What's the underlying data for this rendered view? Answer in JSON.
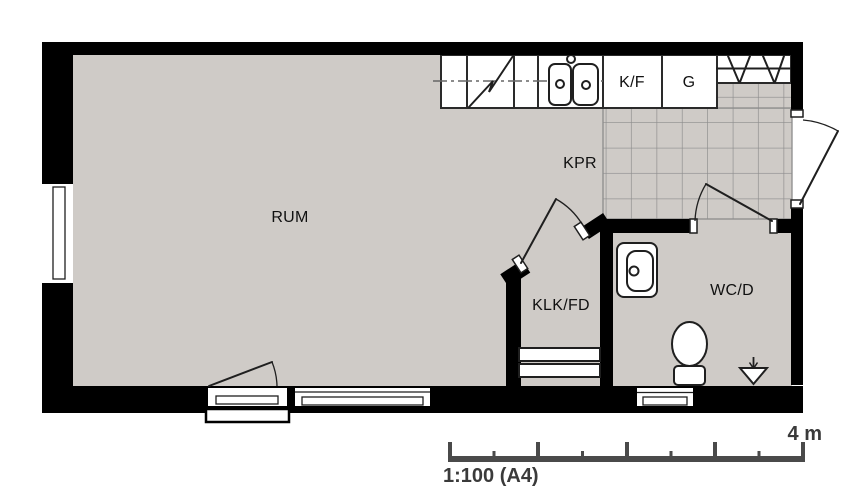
{
  "rooms": {
    "rum": {
      "label": "RUM"
    },
    "kpr": {
      "label": "KPR"
    },
    "klk_fd": {
      "label": "KLK/FD"
    },
    "wc_d": {
      "label": "WC/D"
    }
  },
  "kitchen": {
    "fridge_freezer_label": "K/F",
    "wardrobe_label": "G"
  },
  "scale_bar": {
    "length_label": "4 m",
    "scale_label": "1:100 (A4)",
    "meters": 4,
    "major_tick_interval_m": 1,
    "minor_tick_interval_m": 0.5
  },
  "icons": {
    "stove": "diagonal-zigzag-in-counter",
    "double_sink": "two-rounded-basins-with-drain-circles-and-tap",
    "coat_rack": "hat-shelf-with-v-marks",
    "washbasin": "rounded-basin-with-drain-circle",
    "toilet": "oval-bowl-with-cistern",
    "floor_drain": "down-triangle-with-arrow",
    "window": "white-wall-opening-with-double-line",
    "door": "leaf-line-with-quarter-arc-swing"
  },
  "colors": {
    "background": "#FFFFFF",
    "floor": "#CFCBC7",
    "wall": "#000000",
    "fixture_line": "#1F1F1F",
    "tile_grid": "#8C8C8C",
    "scale_bar": "#4A4A4A",
    "label_text": "#111111"
  }
}
